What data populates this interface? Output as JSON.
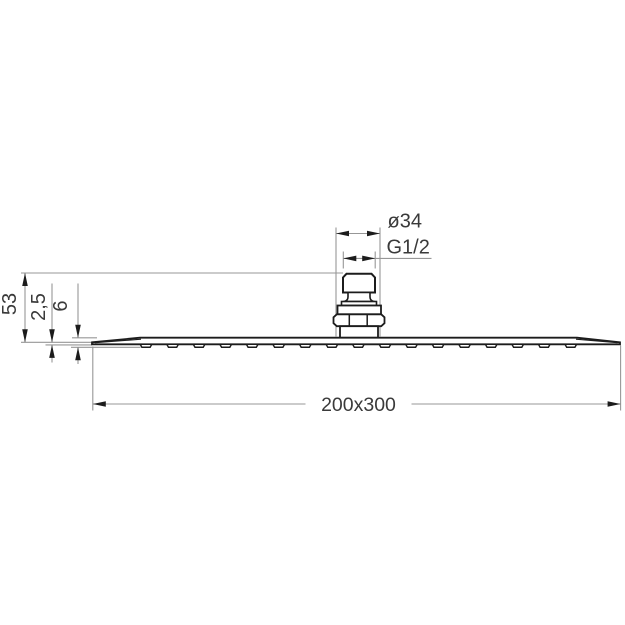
{
  "drawing": {
    "type": "technical-dimension-drawing",
    "subject": "overhead rain shower head, side elevation",
    "labels": {
      "diameter": "ø34",
      "thread": "G1/2",
      "height_total": "53",
      "plate_thickness": "2,5",
      "plate_height_with_nozzles": "6",
      "plate_size": "200x300"
    },
    "plate": {
      "nozzle_count": 17,
      "nozzle_first_center_x": 146,
      "nozzle_spacing": 26.55
    },
    "colors": {
      "outline": "#1c1c1c",
      "dimension_line": "#979797",
      "arrow": "#1c1c1c",
      "text": "#3a3a3a",
      "background": "#ffffff"
    }
  }
}
